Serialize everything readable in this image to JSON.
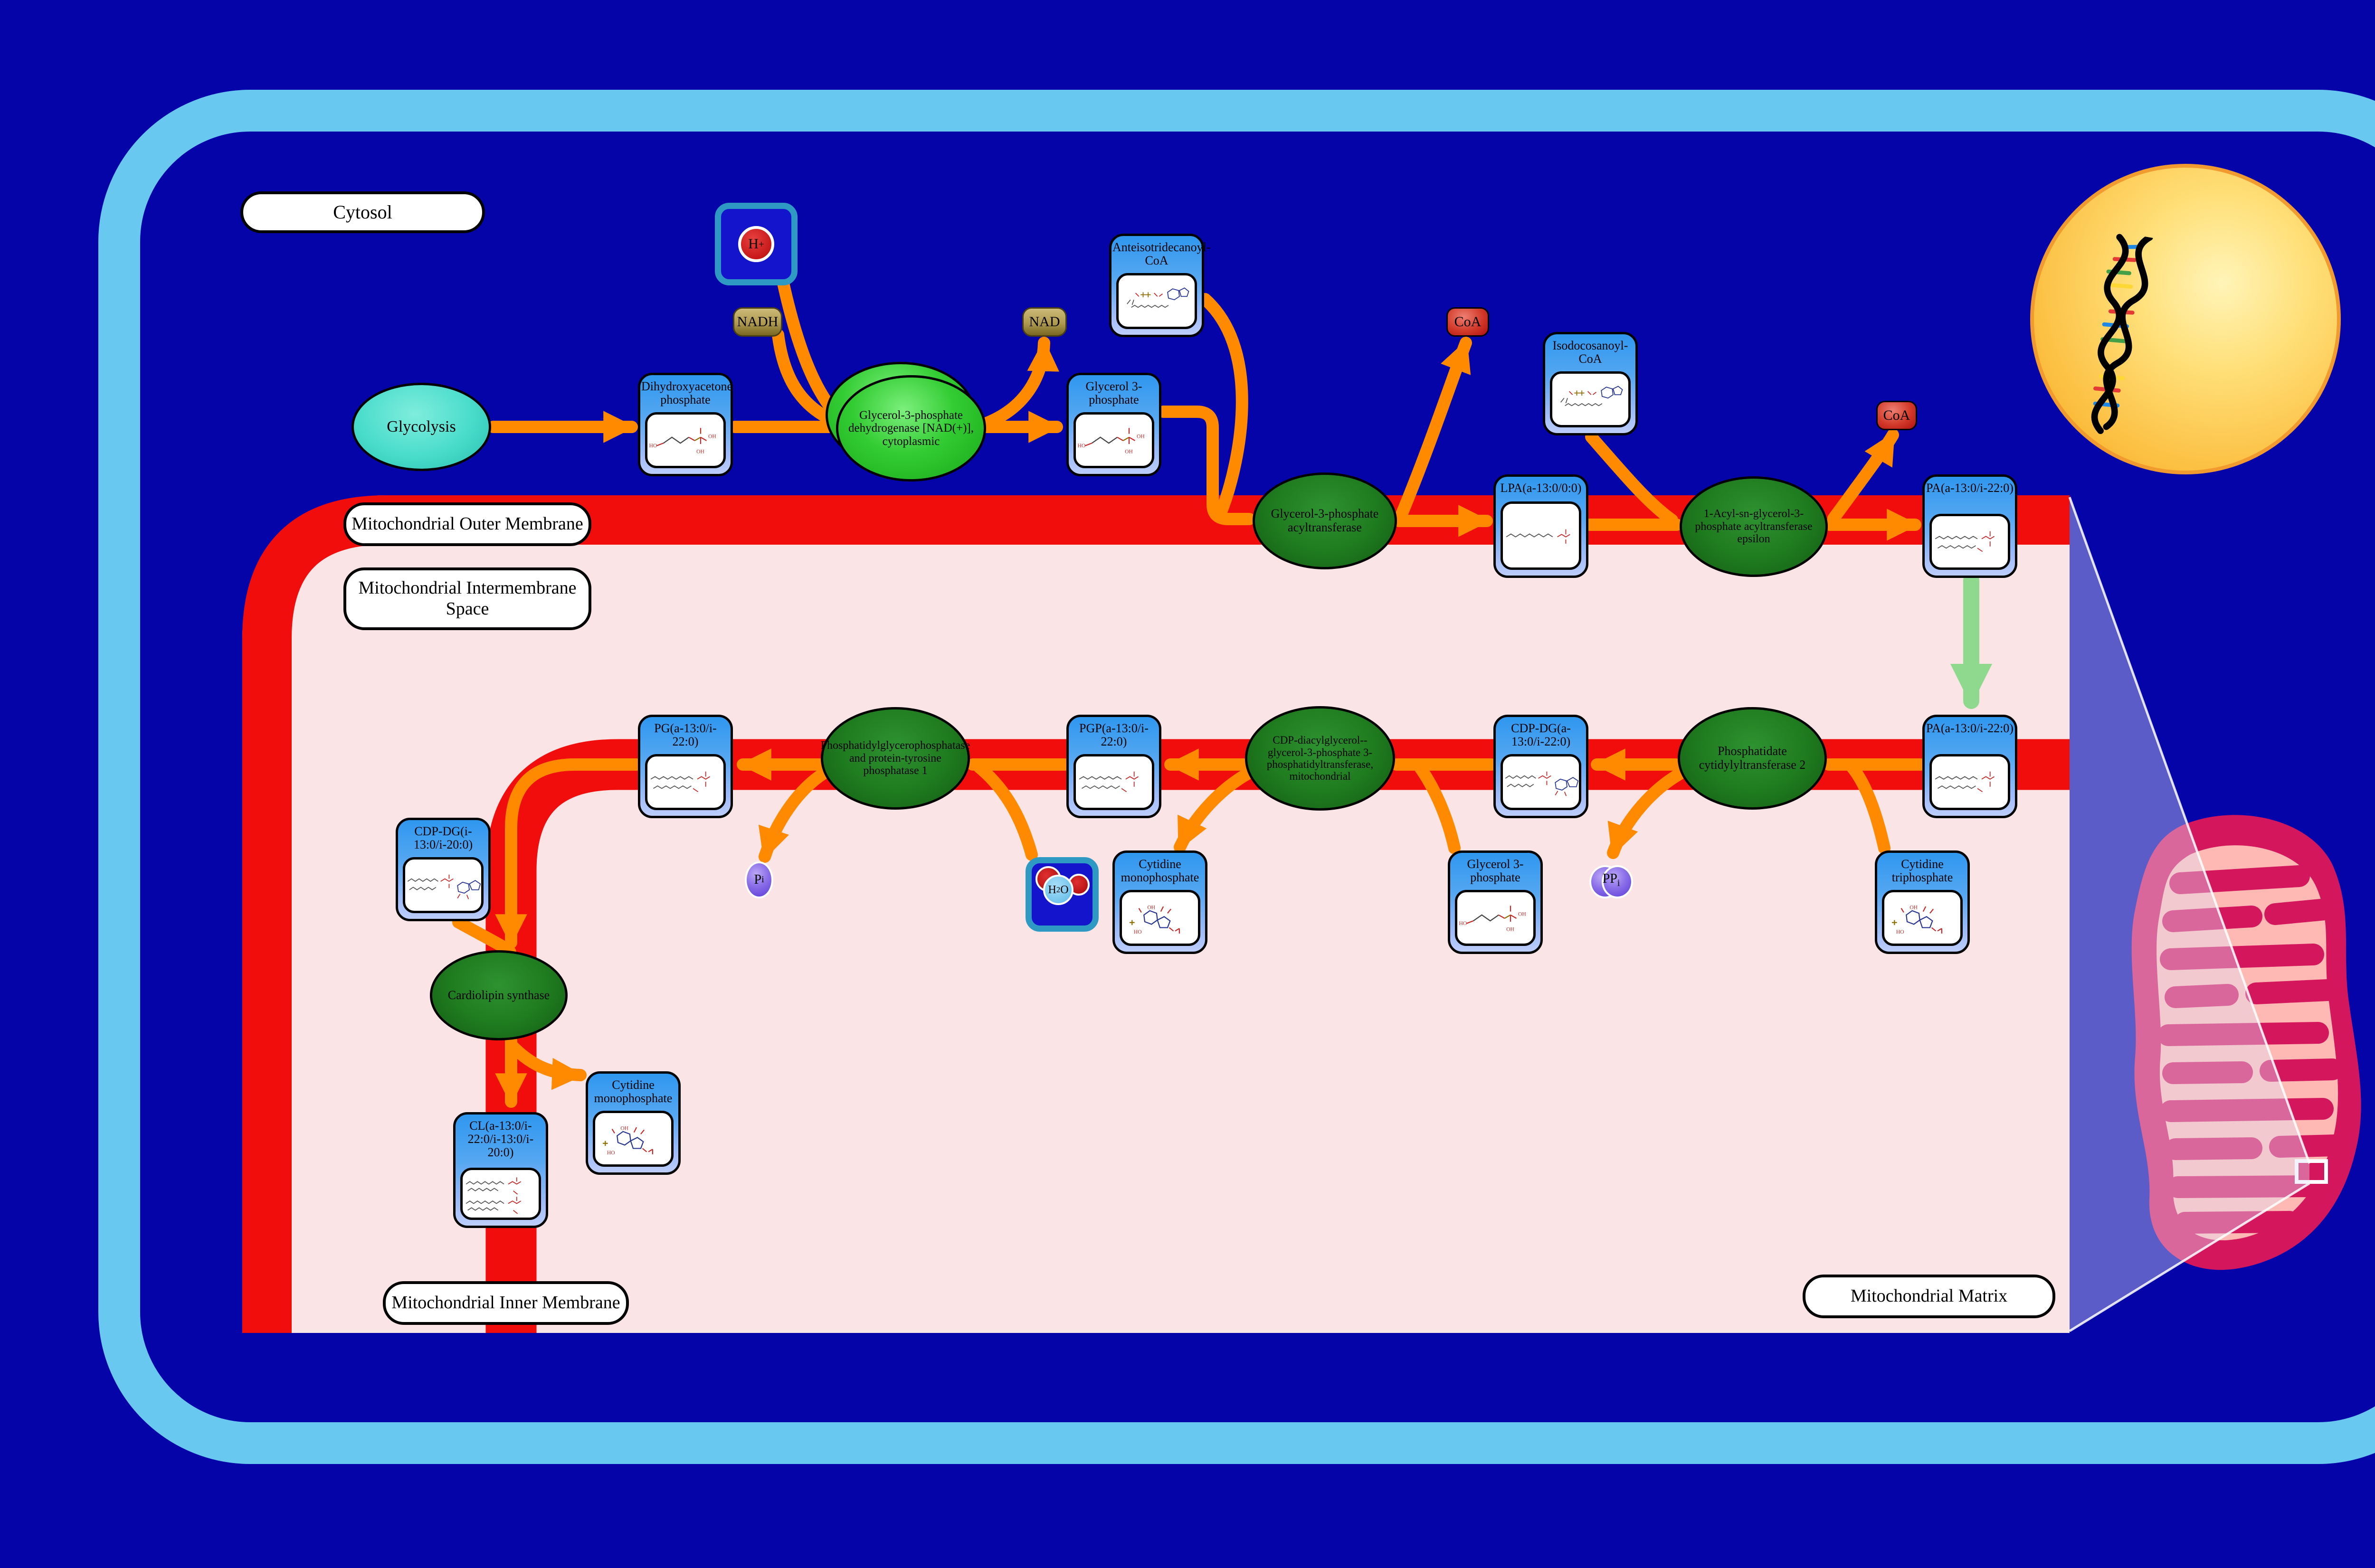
{
  "labels": {
    "cytosol": "Cytosol",
    "outer_membrane": "Mitochondrial Outer Membrane",
    "intermembrane_space": "Mitochondrial Intermembrane Space",
    "inner_membrane": "Mitochondrial Inner Membrane",
    "matrix": "Mitochondrial Matrix"
  },
  "process": {
    "glycolysis": "Glycolysis"
  },
  "metabolites": {
    "dhap": "Dihydroxyacetone phosphate",
    "g3p_top": "Glycerol 3-phosphate",
    "anteiso_coa": "Anteisotridecanoyl-CoA",
    "isodoco_coa": "Isodocosanoyl-CoA",
    "lpa": "LPA(a-13:0/0:0)",
    "pa_top": "PA(a-13:0/i-22:0)",
    "pa_bottom": "PA(a-13:0/i-22:0)",
    "cdpdg_a": "CDP-DG(a-13:0/i-22:0)",
    "pgp": "PGP(a-13:0/i-22:0)",
    "pg": "PG(a-13:0/i-22:0)",
    "cmp1": "Cytidine monophosphate",
    "g3p_bottom": "Glycerol 3-phosphate",
    "ctp": "Cytidine triphosphate",
    "cdpdg_i": "CDP-DG(i-13:0/i-20:0)",
    "cl": "CL(a-13:0/i-22:0/i-13:0/i-20:0)",
    "cmp2": "Cytidine monophosphate"
  },
  "enzymes": {
    "gpd": "Glycerol-3-phosphate dehydrogenase [NAD(+)], cytoplasmic",
    "gpat": "Glycerol-3-phosphate acyltransferase",
    "agpat": "1-Acyl-sn-glycerol-3-phosphate acyltransferase epsilon",
    "ptpmt1": "Phosphatidylglycerophosphatase and protein-tyrosine phosphatase 1",
    "pgs1": "CDP-diacylglycerol--glycerol-3-phosphate 3-phosphatidyltransferase, mitochondrial",
    "cds2": "Phosphatidate cytidylyltransferase 2",
    "crls1": "Cardiolipin synthase"
  },
  "cofactors": {
    "h_base": "H",
    "h_sup": "+",
    "nadh": "NADH",
    "nad": "NAD",
    "coa1": "CoA",
    "coa2": "CoA",
    "pi_base": "P",
    "pi_sub": "i",
    "h2o_h": "H",
    "h2o_2": "2",
    "h2o_o": "O",
    "ppi_base": "PP",
    "ppi_sub": "i"
  },
  "colors": {
    "background": "#0404A8",
    "cell_border": "#69C8F0",
    "membrane_red": "#F20D0D",
    "compartment_pink": "#FBE4E6",
    "arrow_orange": "#FF8A00",
    "transport_green": "#8FD98F",
    "node_blue": "#2F97EF",
    "enzyme_green_bright": "#33CC33",
    "enzyme_green_dark": "#1E7A1E",
    "mito_outer": "#D4175C",
    "mito_matrix": "#FFB9B4",
    "nucleus_gold": "#FBBA38"
  }
}
